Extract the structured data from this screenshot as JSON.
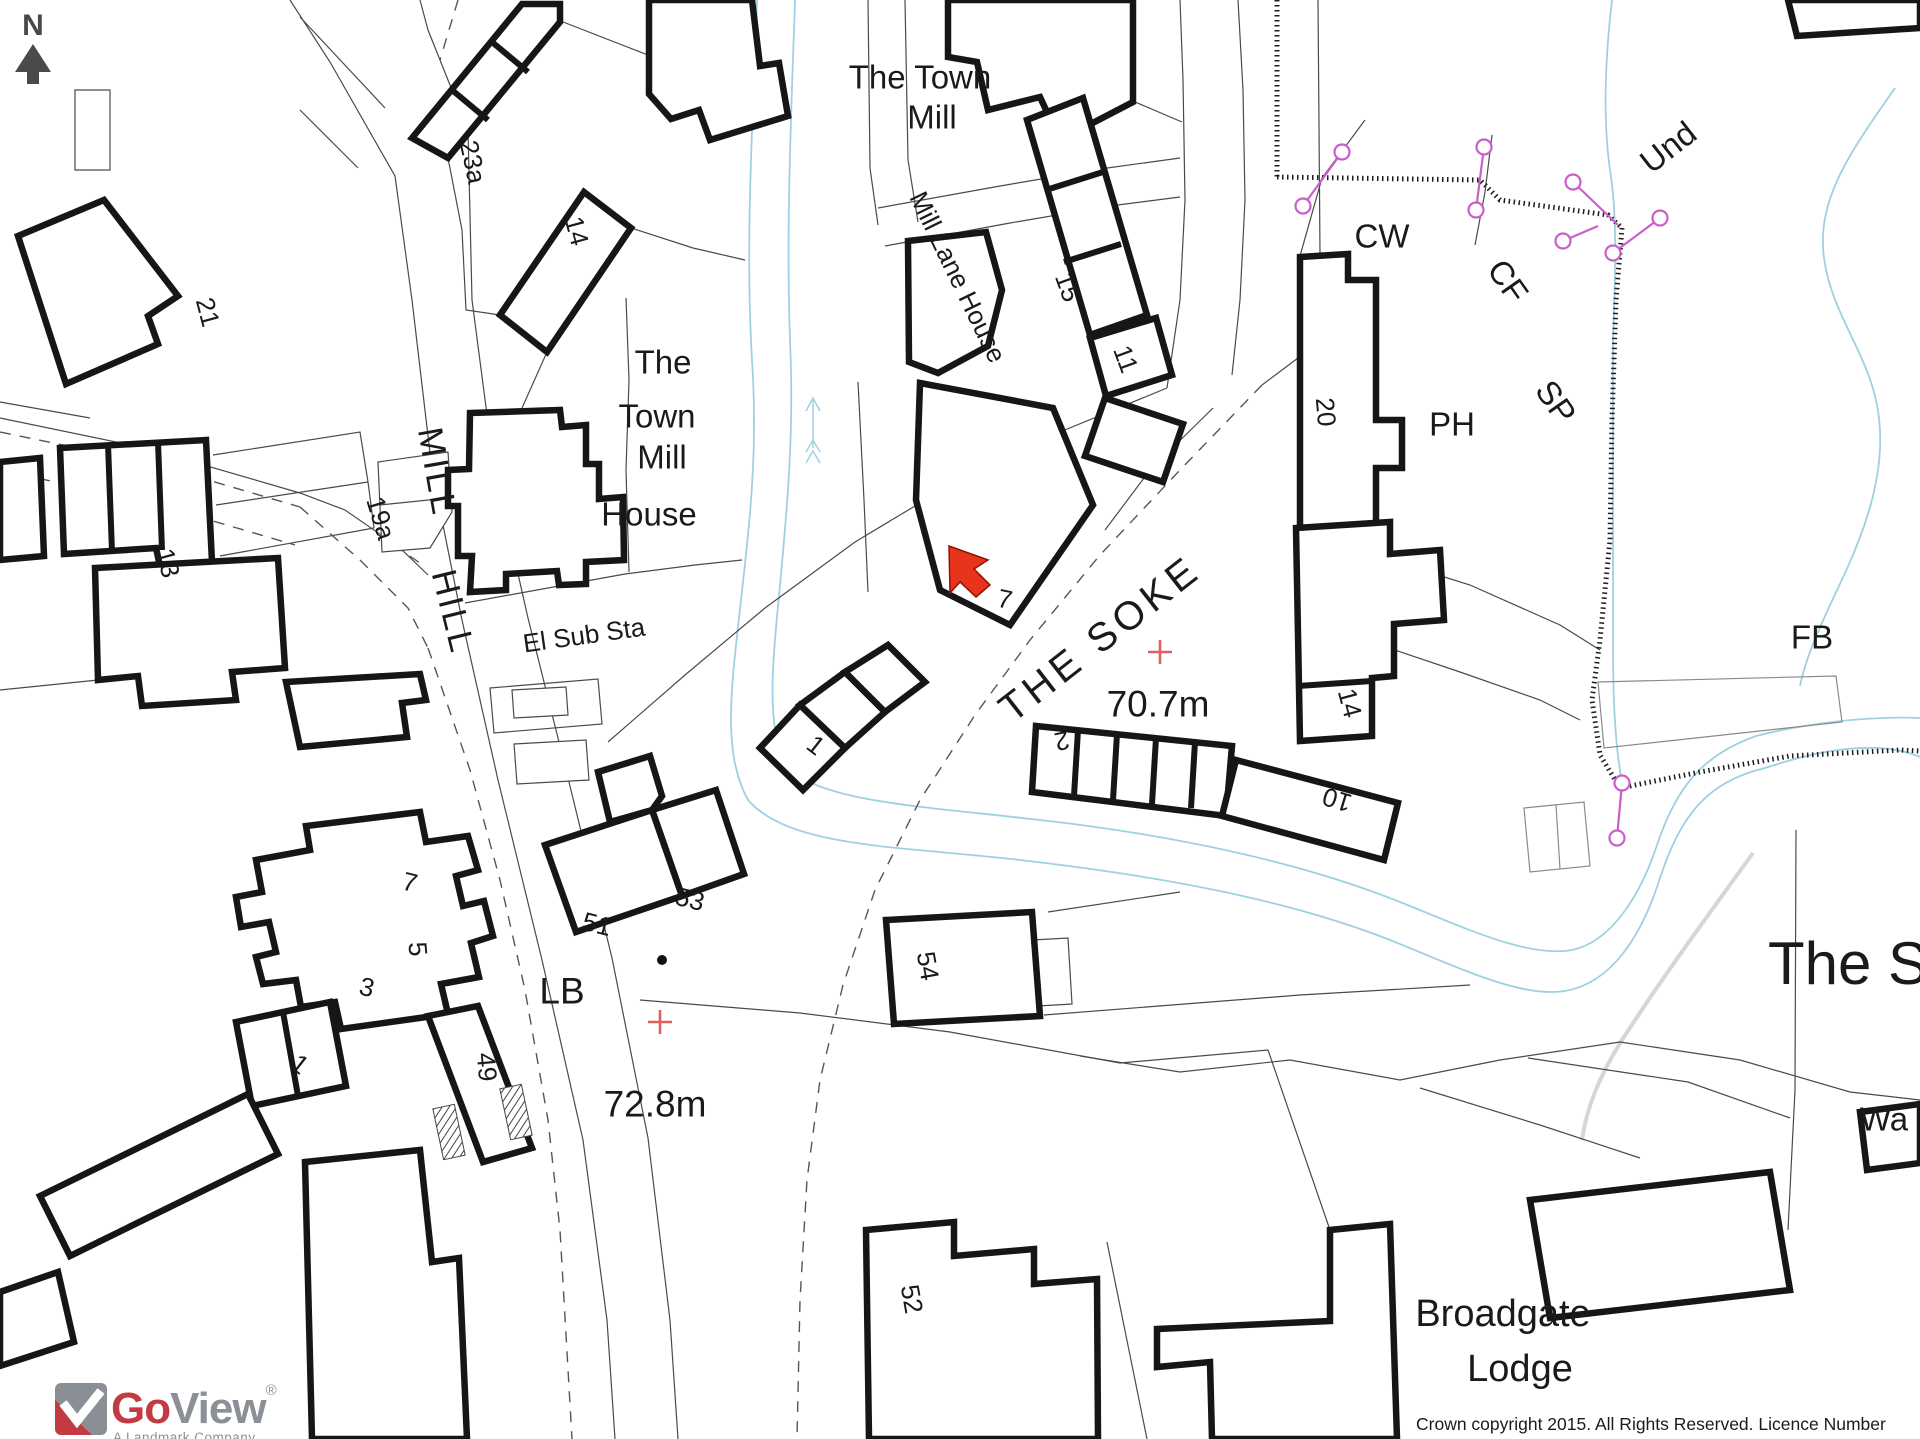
{
  "colors": {
    "building_outline": "#161616",
    "water": "#9fd0e2",
    "boundary_marker_pink": "#c95fc9",
    "target_marker_red": "#e8341c",
    "benchmark_cross_red": "#dd5f5f",
    "north_arrow_gray": "#4a4a4a",
    "logo_red": "#c23a42",
    "logo_gray": "#8a9096"
  },
  "north_indicator": {
    "letter": "N"
  },
  "target_marker": {
    "shape": "red-arrow",
    "points_at_building": "7"
  },
  "map": {
    "labels": [
      {
        "id": "the-town-mill-line1",
        "text": "The Town",
        "x": 920,
        "y": 77,
        "rot": 0,
        "size": 33
      },
      {
        "id": "the-town-mill-line2",
        "text": "Mill",
        "x": 932,
        "y": 117,
        "rot": 0,
        "size": 33
      },
      {
        "id": "mill-lane-house",
        "text": "Mill Lane House",
        "x": 958,
        "y": 277,
        "rot": 64,
        "size": 26
      },
      {
        "id": "no-23a",
        "text": "23a",
        "x": 473,
        "y": 162,
        "rot": 78,
        "size": 26
      },
      {
        "id": "no-14-north",
        "text": "14",
        "x": 577,
        "y": 231,
        "rot": 75,
        "size": 26
      },
      {
        "id": "no-21",
        "text": "21",
        "x": 208,
        "y": 312,
        "rot": 75,
        "size": 26
      },
      {
        "id": "no-15",
        "text": "15",
        "x": 1068,
        "y": 287,
        "rot": 70,
        "size": 26
      },
      {
        "id": "no-11",
        "text": "11",
        "x": 1126,
        "y": 359,
        "rot": 70,
        "size": 26
      },
      {
        "id": "cw",
        "text": "CW",
        "x": 1382,
        "y": 236,
        "rot": 0,
        "size": 33
      },
      {
        "id": "cf",
        "text": "CF",
        "x": 1508,
        "y": 281,
        "rot": 55,
        "size": 33
      },
      {
        "id": "sp",
        "text": "SP",
        "x": 1556,
        "y": 402,
        "rot": 55,
        "size": 33
      },
      {
        "id": "und",
        "text": "Und",
        "x": 1668,
        "y": 147,
        "rot": -38,
        "size": 33
      },
      {
        "id": "no-20",
        "text": "20",
        "x": 1326,
        "y": 412,
        "rot": 85,
        "size": 26
      },
      {
        "id": "ph",
        "text": "PH",
        "x": 1452,
        "y": 424,
        "rot": 0,
        "size": 33
      },
      {
        "id": "tmh-line1",
        "text": "The",
        "x": 663,
        "y": 362,
        "rot": 0,
        "size": 33
      },
      {
        "id": "tmh-line2",
        "text": "Town",
        "x": 657,
        "y": 416,
        "rot": 0,
        "size": 33
      },
      {
        "id": "tmh-line3",
        "text": "Mill",
        "x": 662,
        "y": 457,
        "rot": 0,
        "size": 33
      },
      {
        "id": "tmh-line4",
        "text": "House",
        "x": 649,
        "y": 514,
        "rot": 0,
        "size": 33
      },
      {
        "id": "street-mill",
        "text": "MILL",
        "x": 437,
        "y": 472,
        "rot": 80,
        "size": 35,
        "ls": 3
      },
      {
        "id": "street-hill",
        "text": "HILL",
        "x": 453,
        "y": 612,
        "rot": 76,
        "size": 35,
        "ls": 3
      },
      {
        "id": "el-sub-sta",
        "text": "El Sub Sta",
        "x": 584,
        "y": 635,
        "rot": -8,
        "size": 26
      },
      {
        "id": "no-19a",
        "text": "19a",
        "x": 381,
        "y": 518,
        "rot": 73,
        "size": 26
      },
      {
        "id": "no-13",
        "text": "13",
        "x": 168,
        "y": 563,
        "rot": 75,
        "size": 26
      },
      {
        "id": "no-7-center",
        "text": "7",
        "x": 1005,
        "y": 599,
        "rot": 12,
        "size": 26
      },
      {
        "id": "no-1-center",
        "text": "1",
        "x": 816,
        "y": 745,
        "rot": 38,
        "size": 26
      },
      {
        "id": "street-the-soke",
        "text": "THE SOKE",
        "x": 1100,
        "y": 639,
        "rot": -38,
        "size": 40,
        "ls": 5
      },
      {
        "id": "spot-70-7m",
        "text": "70.7m",
        "x": 1158,
        "y": 704,
        "rot": 0,
        "size": 37
      },
      {
        "id": "no-2",
        "text": "2",
        "x": 1062,
        "y": 741,
        "rot": 168,
        "size": 26
      },
      {
        "id": "no-10",
        "text": "10",
        "x": 1337,
        "y": 800,
        "rot": 197,
        "size": 26
      },
      {
        "id": "no-14-south",
        "text": "14",
        "x": 1350,
        "y": 703,
        "rot": 75,
        "size": 26
      },
      {
        "id": "fb",
        "text": "FB",
        "x": 1812,
        "y": 637,
        "rot": 0,
        "size": 33
      },
      {
        "id": "no-53",
        "text": "53",
        "x": 690,
        "y": 899,
        "rot": 14,
        "size": 26
      },
      {
        "id": "no-51",
        "text": "51",
        "x": 597,
        "y": 924,
        "rot": 14,
        "size": 26
      },
      {
        "id": "lb",
        "text": "LB",
        "x": 562,
        "y": 991,
        "rot": 0,
        "size": 37
      },
      {
        "id": "spot-72-8m",
        "text": "72.8m",
        "x": 655,
        "y": 1104,
        "rot": 0,
        "size": 37
      },
      {
        "id": "no-3",
        "text": "3",
        "x": 367,
        "y": 987,
        "rot": 14,
        "size": 26
      },
      {
        "id": "no-5",
        "text": "5",
        "x": 418,
        "y": 949,
        "rot": 85,
        "size": 26
      },
      {
        "id": "no-7-sw",
        "text": "7",
        "x": 410,
        "y": 882,
        "rot": 14,
        "size": 26
      },
      {
        "id": "no-1-sw",
        "text": "1",
        "x": 300,
        "y": 1064,
        "rot": 38,
        "size": 26
      },
      {
        "id": "no-49",
        "text": "49",
        "x": 487,
        "y": 1067,
        "rot": 85,
        "size": 26
      },
      {
        "id": "no-54",
        "text": "54",
        "x": 928,
        "y": 966,
        "rot": 80,
        "size": 26
      },
      {
        "id": "no-52",
        "text": "52",
        "x": 912,
        "y": 1299,
        "rot": 80,
        "size": 26
      },
      {
        "id": "broadgate",
        "text": "Broadgate",
        "x": 1503,
        "y": 1314,
        "rot": 0,
        "size": 38
      },
      {
        "id": "lodge",
        "text": "Lodge",
        "x": 1520,
        "y": 1369,
        "rot": 0,
        "size": 38
      },
      {
        "id": "the-s",
        "text": "The S",
        "x": 1848,
        "y": 964,
        "rot": 0,
        "size": 60
      },
      {
        "id": "wa",
        "text": "Wa",
        "x": 1884,
        "y": 1119,
        "rot": 0,
        "size": 33
      },
      {
        "id": "north-letter",
        "text": "N",
        "x": 33,
        "y": 26,
        "rot": 0,
        "size": 30,
        "weight": "bold",
        "color": "#4a4a4a"
      }
    ]
  },
  "logo": {
    "brand_go": "Go",
    "brand_view": "View",
    "registered": "®",
    "tagline": "A Landmark Company"
  },
  "copyright": {
    "text": "Crown copyright 2015. All Rights Reserved. Licence Number 100022432."
  }
}
